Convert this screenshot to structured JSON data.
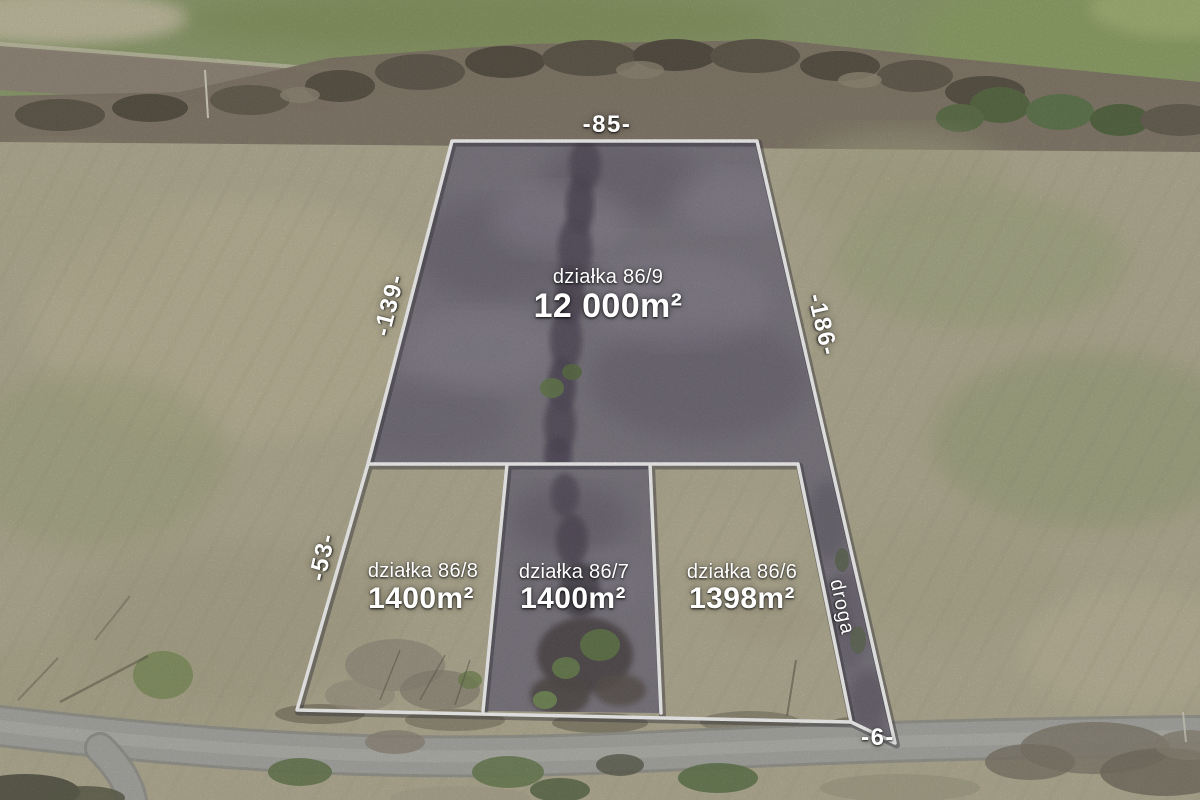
{
  "scene": {
    "description": "Aerial drone photo of surveyed land parcels with boundary overlay",
    "language": "pl"
  },
  "plots": [
    {
      "name": "działka 86/9",
      "area": "12 000m²",
      "highlighted": true
    },
    {
      "name": "działka 86/8",
      "area": "1400m²",
      "highlighted": false
    },
    {
      "name": "działka 86/7",
      "area": "1400m²",
      "highlighted": true
    },
    {
      "name": "działka 86/6",
      "area": "1398m²",
      "highlighted": false
    }
  ],
  "dimensions": {
    "top": "-85-",
    "left_upper": "-139-",
    "left_lower": "-53-",
    "right": "-186-",
    "bottom": "-6-"
  },
  "road_label": "droga",
  "colors": {
    "boundary_line": "#ffffff",
    "label_text": "#ffffff",
    "highlight_tint": "#716b7a",
    "field_tan": "#b3ac90",
    "field_green": "#8b9a66",
    "road_gray": "#a6a6a1",
    "tree_band": "#7b7060"
  }
}
